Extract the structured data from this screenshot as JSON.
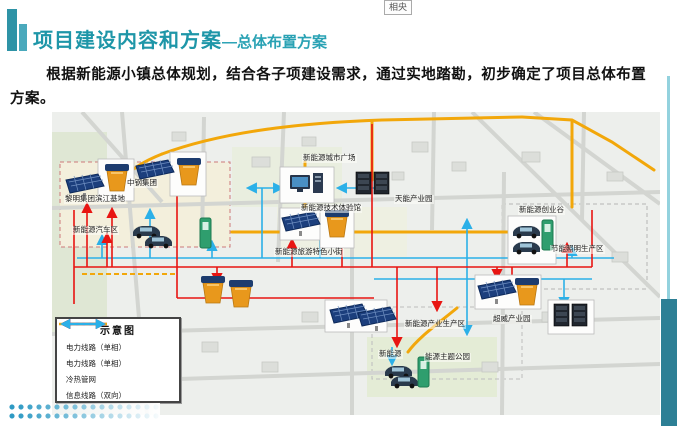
{
  "window": {
    "note_box": "相央"
  },
  "header": {
    "title": "项目建设内容和方案",
    "subtitle": "—总体布置方案"
  },
  "body": {
    "paragraph": "根据新能源小镇总体规划，结合各子项建设需求，通过实地踏勘，初步确定了项目总体布置方案。"
  },
  "map": {
    "labels": [
      {
        "text": "黎明集团滨江基地"
      },
      {
        "text": "中钢集团"
      },
      {
        "text": "新能源汽车区"
      },
      {
        "text": "新能源城市广场"
      },
      {
        "text": "新能源技术体验馆"
      },
      {
        "text": "天能产业园"
      },
      {
        "text": "新能源创业谷"
      },
      {
        "text": "节能照明生产区"
      },
      {
        "text": "新能源旅游特色小街"
      },
      {
        "text": "新能源产业生产区"
      },
      {
        "text": "超威产业园"
      },
      {
        "text": "新能源"
      },
      {
        "text": "能源主题公园"
      }
    ],
    "legend": {
      "title": "示意图",
      "items": [
        {
          "label": "电力线路（单相）",
          "style": "single-arrow",
          "color": "#e8150d"
        },
        {
          "label": "电力线路（单相）",
          "style": "double-arrow",
          "color": "#e8150d"
        },
        {
          "label": "冷热管网",
          "style": "dashed-line",
          "color": "#f2a70a"
        },
        {
          "label": "信息线路（双向）",
          "style": "double-arrow",
          "color": "#2bb0e8"
        }
      ]
    }
  },
  "colors": {
    "accent_teal": "#1e96a8",
    "power_red": "#e8150d",
    "info_blue": "#2bb0e8",
    "pipe_yellow": "#f2a70a",
    "side_bar_teal": "#2d7f95"
  }
}
